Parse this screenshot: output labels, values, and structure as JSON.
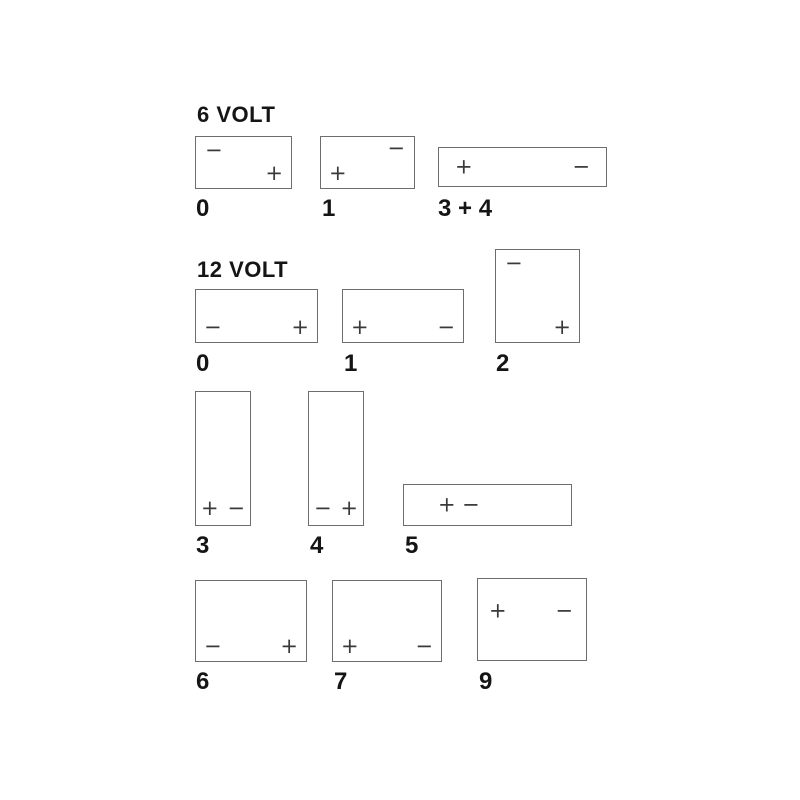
{
  "diagram_title": "Battery terminal layout codes",
  "colors": {
    "background": "#ffffff",
    "box_border": "#6d6d6d",
    "terminal_sign": "#3a3a3a",
    "text": "#151515"
  },
  "sections": [
    {
      "title": "6 VOLT",
      "batteries": [
        {
          "label": "0",
          "terminals": [
            {
              "sign": "−",
              "position": "top-left"
            },
            {
              "sign": "+",
              "position": "bottom-right"
            }
          ]
        },
        {
          "label": "1",
          "terminals": [
            {
              "sign": "−",
              "position": "top-right"
            },
            {
              "sign": "+",
              "position": "bottom-left"
            }
          ]
        },
        {
          "label": "3 + 4",
          "terminals": [
            {
              "sign": "+",
              "position": "middle-left"
            },
            {
              "sign": "−",
              "position": "middle-right"
            }
          ]
        }
      ]
    },
    {
      "title": "12 VOLT",
      "batteries": [
        {
          "label": "0",
          "terminals": [
            {
              "sign": "−",
              "position": "bottom-left"
            },
            {
              "sign": "+",
              "position": "bottom-right"
            }
          ]
        },
        {
          "label": "1",
          "terminals": [
            {
              "sign": "+",
              "position": "bottom-left"
            },
            {
              "sign": "−",
              "position": "bottom-right"
            }
          ]
        },
        {
          "label": "2",
          "terminals": [
            {
              "sign": "−",
              "position": "top-left"
            },
            {
              "sign": "+",
              "position": "bottom-right"
            }
          ]
        },
        {
          "label": "3",
          "terminals": [
            {
              "sign": "+",
              "position": "bottom-left"
            },
            {
              "sign": "−",
              "position": "bottom-right"
            }
          ]
        },
        {
          "label": "4",
          "terminals": [
            {
              "sign": "−",
              "position": "bottom-left"
            },
            {
              "sign": "+",
              "position": "bottom-right"
            }
          ]
        },
        {
          "label": "5",
          "terminals": [
            {
              "sign": "+",
              "position": "middle-left"
            },
            {
              "sign": "−",
              "position": "middle-left-adjacent"
            }
          ]
        },
        {
          "label": "6",
          "terminals": [
            {
              "sign": "−",
              "position": "bottom-left"
            },
            {
              "sign": "+",
              "position": "bottom-right"
            }
          ]
        },
        {
          "label": "7",
          "terminals": [
            {
              "sign": "+",
              "position": "bottom-left"
            },
            {
              "sign": "−",
              "position": "bottom-right"
            }
          ]
        },
        {
          "label": "9",
          "terminals": [
            {
              "sign": "+",
              "position": "upper-middle-left"
            },
            {
              "sign": "−",
              "position": "upper-middle-right"
            }
          ]
        }
      ]
    }
  ]
}
